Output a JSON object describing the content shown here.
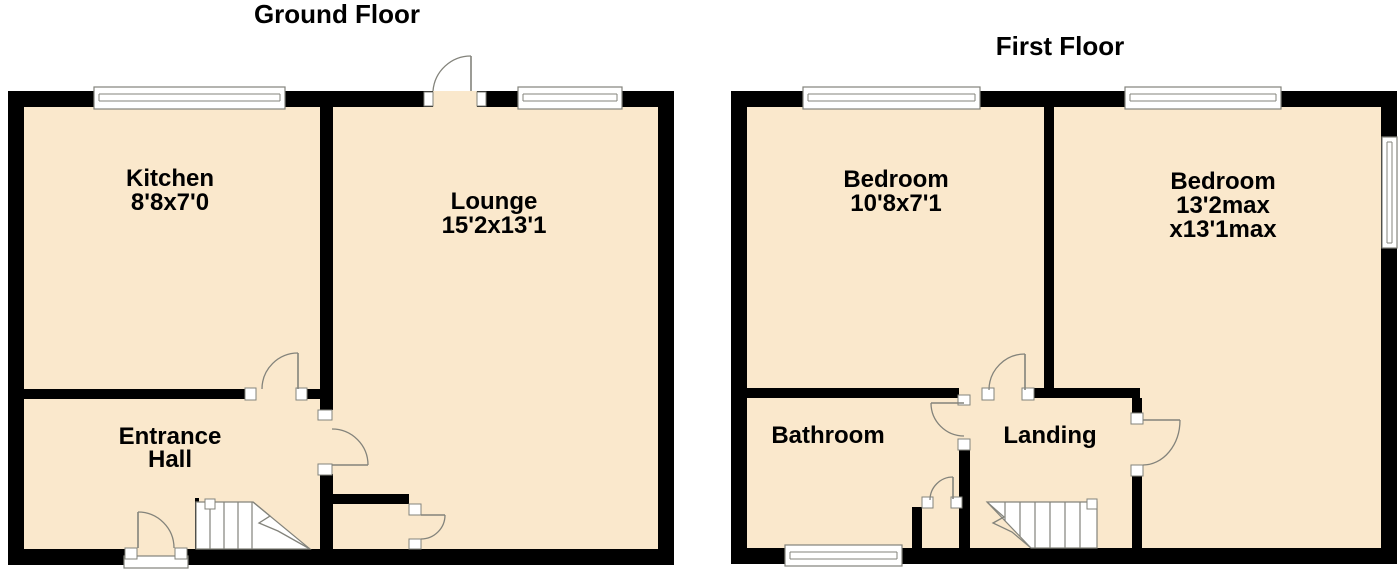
{
  "document_type": "floorplan",
  "colors": {
    "floor_fill": "#FAE8CC",
    "wall": "#000000",
    "line": "#83837B",
    "text": "#000000",
    "background": "#FFFFFF"
  },
  "ground_floor": {
    "title": "Ground Floor",
    "rooms": {
      "kitchen": {
        "name": "Kitchen",
        "dims": "8'8x7'0"
      },
      "lounge": {
        "name": "Lounge",
        "dims": "15'2x13'1"
      },
      "entrance_hall": {
        "name_line1": "Entrance",
        "name_line2": "Hall"
      }
    }
  },
  "first_floor": {
    "title": "First Floor",
    "rooms": {
      "bedroom_left": {
        "name": "Bedroom",
        "dims": "10'8x7'1"
      },
      "bedroom_right": {
        "name": "Bedroom",
        "dims_line1": "13'2max",
        "dims_line2": "x13'1max"
      },
      "bathroom": {
        "name": "Bathroom"
      },
      "landing": {
        "name": "Landing"
      }
    }
  }
}
